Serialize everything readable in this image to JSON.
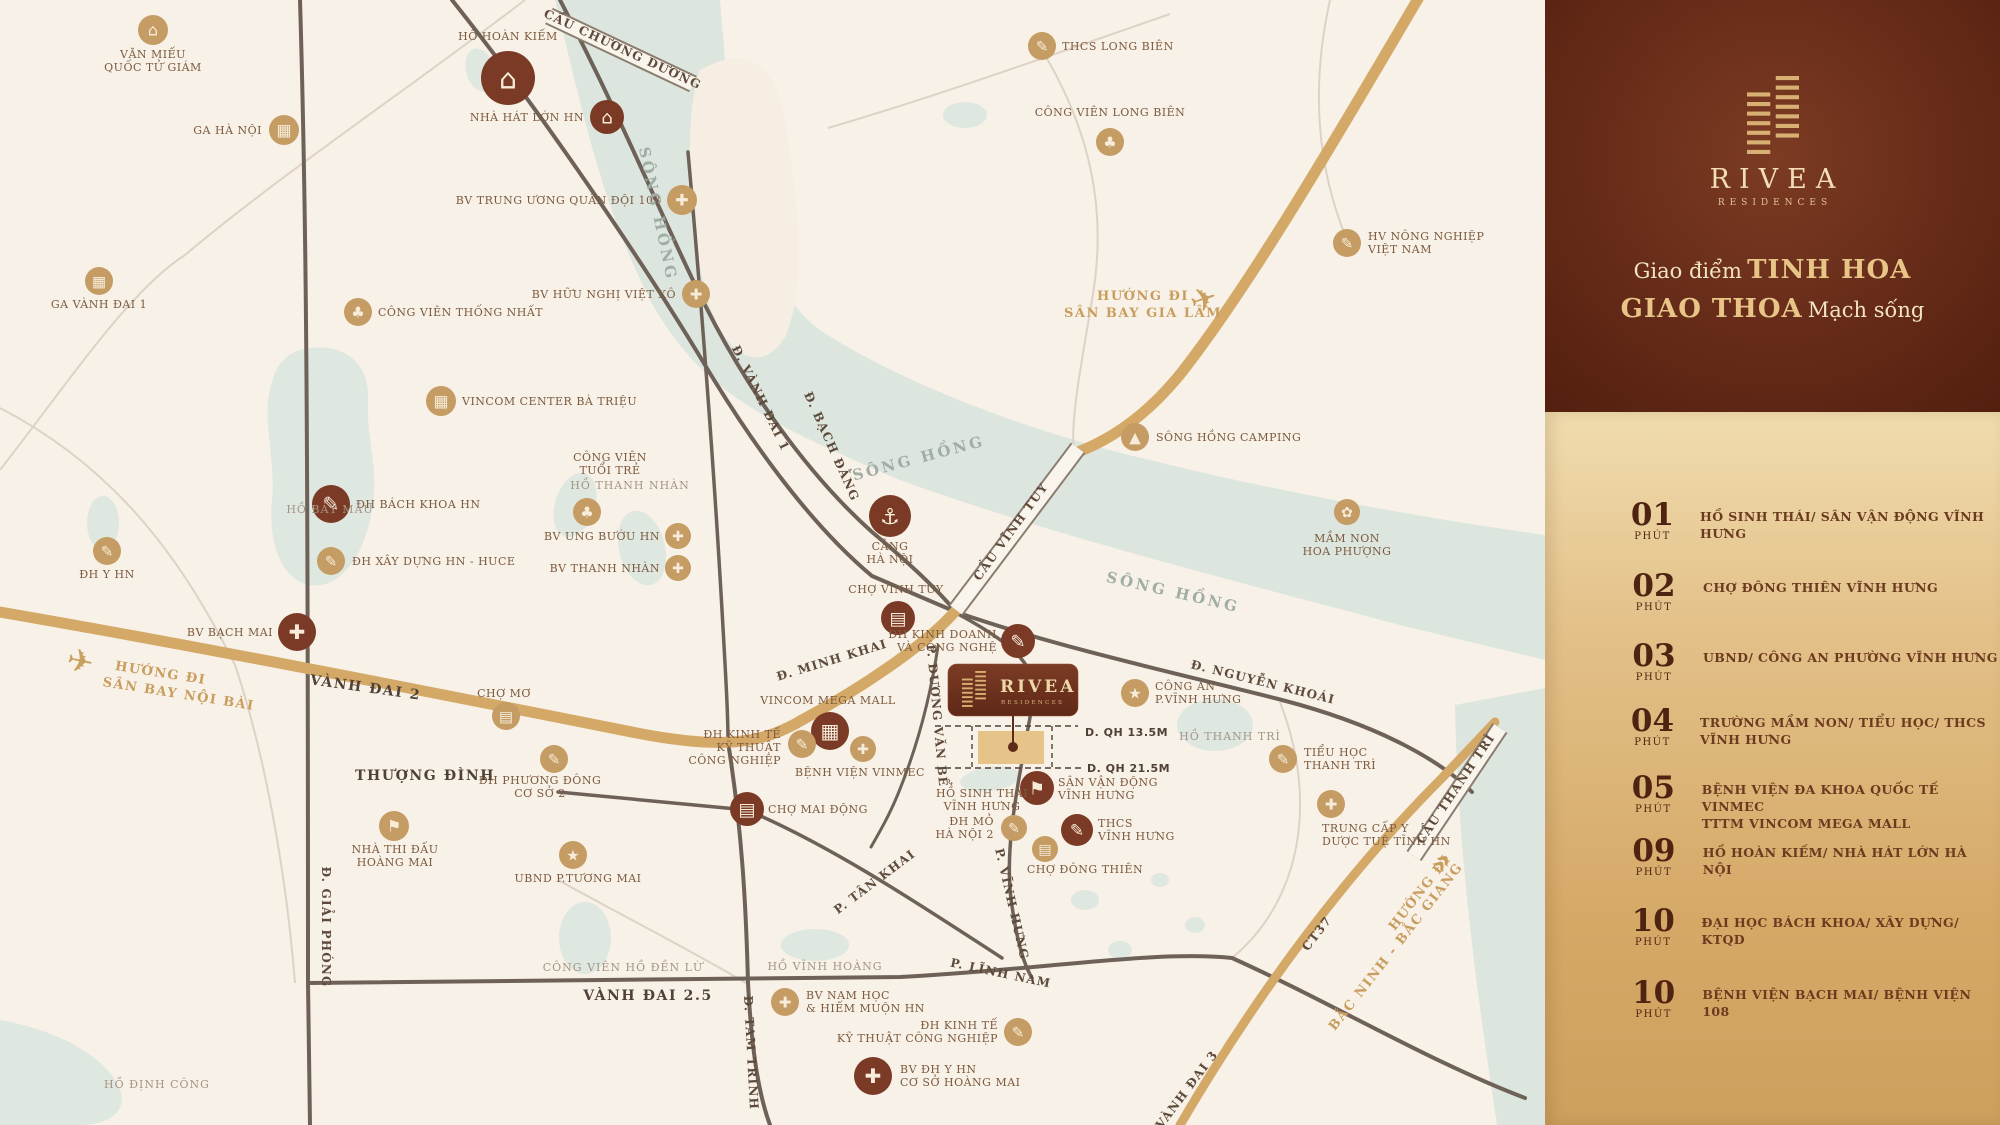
{
  "panel": {
    "brand": "RIVEA",
    "brand_sub": "RESIDENCES",
    "tagline": {
      "l1_regular": "Giao điểm",
      "l1_emphasis": "TINH HOA",
      "l2_emphasis": "GIAO THOA",
      "l2_regular": "Mạch sống"
    },
    "items": [
      {
        "minutes": "01",
        "unit": "PHÚT",
        "label": "HỒ SINH THÁI/ SÂN VẬN ĐỘNG VĨNH HƯNG"
      },
      {
        "minutes": "02",
        "unit": "PHÚT",
        "label": "CHỢ ĐÔNG THIÊN VĨNH HƯNG"
      },
      {
        "minutes": "03",
        "unit": "PHÚT",
        "label": "UBND/ CÔNG AN PHƯỜNG VĨNH HƯNG"
      },
      {
        "minutes": "04",
        "unit": "PHÚT",
        "label": "TRƯỜNG MẦM NON/ TIỂU HỌC/ THCS VĨNH HƯNG"
      },
      {
        "minutes": "05",
        "unit": "PHÚT",
        "label": "BỆNH VIỆN ĐA KHOA QUỐC TẾ VINMEC\nTTTM VINCOM MEGA MALL"
      },
      {
        "minutes": "09",
        "unit": "PHÚT",
        "label": "HỒ HOÀN KIẾM/ NHÀ HÁT LỚN HÀ NỘI"
      },
      {
        "minutes": "10",
        "unit": "PHÚT",
        "label": "ĐẠI HỌC BÁCH KHOA/ XÂY DỰNG/ KTQD"
      },
      {
        "minutes": "10",
        "unit": "PHÚT",
        "label": "BỆNH VIỆN BẠCH MAI/ BỆNH VIỆN 108"
      }
    ]
  },
  "map": {
    "project": {
      "name": "RIVEA",
      "subtitle": "RESIDENCES"
    },
    "colors": {
      "accent_dark": "#7b3a25",
      "accent_gold": "#c59c63",
      "road_gold": "#d4a967",
      "water": "#dce6df",
      "panel_brown": "#642a18"
    },
    "pois": [
      {
        "id": "van-mieu-quoc-tu-giam",
        "x": 153,
        "y": 30,
        "r": 15,
        "v": "gold",
        "i": "monument",
        "lines": [
          "VĂN MIẾU",
          "QUỐC TỬ GIÁM"
        ],
        "lx": 153,
        "ly": 58,
        "a": "middle"
      },
      {
        "id": "ga-ha-noi",
        "x": 284,
        "y": 130,
        "r": 15,
        "v": "gold",
        "i": "station",
        "lines": [
          "GA HÀ NỘI"
        ],
        "lx": 262,
        "ly": 134,
        "a": "end"
      },
      {
        "id": "ga-vanh-dai-1",
        "x": 99,
        "y": 281,
        "r": 14,
        "v": "gold",
        "i": "station",
        "lines": [
          "GA VÀNH ĐAI 1"
        ],
        "lx": 99,
        "ly": 308,
        "a": "middle"
      },
      {
        "id": "ho-hoan-kiem",
        "x": 508,
        "y": 78,
        "r": 27,
        "v": "dark",
        "i": "monument",
        "lines": [
          "HỒ HOÀN KIẾM"
        ],
        "lx": 508,
        "ly": 40,
        "a": "middle"
      },
      {
        "id": "nha-hat-lon-hn",
        "x": 607,
        "y": 117,
        "r": 17,
        "v": "dark",
        "i": "theatre",
        "lines": [
          "NHÀ HÁT LỚN HN"
        ],
        "lx": 584,
        "ly": 121,
        "a": "end"
      },
      {
        "id": "bv-trung-uong-quan-doi-108",
        "x": 682,
        "y": 200,
        "r": 15,
        "v": "gold",
        "i": "hospital",
        "lines": [
          "BV TRUNG ƯƠNG QUÂN ĐỘI 108"
        ],
        "lx": 661,
        "ly": 204,
        "a": "end"
      },
      {
        "id": "thcs-long-bien",
        "x": 1042,
        "y": 46,
        "r": 14,
        "v": "gold",
        "i": "school",
        "lines": [
          "THCS LONG BIÊN"
        ],
        "lx": 1062,
        "ly": 50,
        "a": "start"
      },
      {
        "id": "cong-vien-long-bien",
        "x": 1110,
        "y": 142,
        "r": 14,
        "v": "gold",
        "i": "park",
        "lines": [
          "CÔNG VIÊN LONG BIÊN"
        ],
        "lx": 1110,
        "ly": 116,
        "a": "middle"
      },
      {
        "id": "cong-vien-thong-nhat",
        "x": 358,
        "y": 312,
        "r": 14,
        "v": "gold",
        "i": "park",
        "lines": [
          "CÔNG VIÊN THỐNG NHẤT"
        ],
        "lx": 378,
        "ly": 316,
        "a": "start"
      },
      {
        "id": "bv-huu-nghi-viet-xo",
        "x": 696,
        "y": 294,
        "r": 14,
        "v": "gold",
        "i": "hospital",
        "lines": [
          "BV HỮU NGHỊ VIỆT XÔ"
        ],
        "lx": 676,
        "ly": 298,
        "a": "end"
      },
      {
        "id": "vincom-center-ba-trieu",
        "x": 441,
        "y": 401,
        "r": 15,
        "v": "gold",
        "i": "mall",
        "lines": [
          "VINCOM CENTER BÀ TRIỆU"
        ],
        "lx": 462,
        "ly": 405,
        "a": "start"
      },
      {
        "id": "hv-nong-nghiep-viet-nam",
        "x": 1347,
        "y": 243,
        "r": 14,
        "v": "gold",
        "i": "school",
        "lines": [
          "HV NÔNG NGHIỆP",
          "VIỆT NAM"
        ],
        "lx": 1368,
        "ly": 240,
        "a": "start"
      },
      {
        "id": "dh-bach-khoa-hn",
        "x": 331,
        "y": 504,
        "r": 19,
        "v": "dark",
        "i": "school",
        "lines": [
          "ĐH BÁCH KHOA HN"
        ],
        "lx": 356,
        "ly": 508,
        "a": "start"
      },
      {
        "id": "dh-xay-dung-hn-huce",
        "x": 331,
        "y": 561,
        "r": 14,
        "v": "gold",
        "i": "school",
        "lines": [
          "ĐH XÂY DỰNG HN - HUCE"
        ],
        "lx": 352,
        "ly": 565,
        "a": "start"
      },
      {
        "id": "dh-y-hn",
        "x": 107,
        "y": 551,
        "r": 14,
        "v": "gold",
        "i": "school",
        "lines": [
          "ĐH Y HN"
        ],
        "lx": 107,
        "ly": 578,
        "a": "middle"
      },
      {
        "id": "bv-bach-mai",
        "x": 297,
        "y": 632,
        "r": 19,
        "v": "dark",
        "i": "hospital",
        "lines": [
          "BV BẠCH MAI"
        ],
        "lx": 273,
        "ly": 636,
        "a": "end"
      },
      {
        "id": "cong-vien-tuoi-tre",
        "x": 587,
        "y": 512,
        "r": 14,
        "v": "gold",
        "i": "park",
        "lines": [
          "CÔNG VIÊN",
          "TUỔI TRẺ"
        ],
        "lx": 610,
        "ly": 461,
        "a": "middle"
      },
      {
        "id": "bv-ung-buou-hn",
        "x": 678,
        "y": 536,
        "r": 13,
        "v": "gold",
        "i": "hospital",
        "lines": [
          "BV UNG BƯỚU HN"
        ],
        "lx": 660,
        "ly": 540,
        "a": "end"
      },
      {
        "id": "bv-thanh-nhan",
        "x": 678,
        "y": 568,
        "r": 13,
        "v": "gold",
        "i": "hospital",
        "lines": [
          "BV THANH NHÀN"
        ],
        "lx": 660,
        "ly": 572,
        "a": "end"
      },
      {
        "id": "cang-ha-noi",
        "x": 890,
        "y": 516,
        "r": 21,
        "v": "dark",
        "i": "port",
        "lines": [
          "CẢNG",
          "HÀ NỘI"
        ],
        "lx": 890,
        "ly": 550,
        "a": "middle"
      },
      {
        "id": "cho-vinh-tuy",
        "x": 898,
        "y": 618,
        "r": 17,
        "v": "dark",
        "i": "market",
        "lines": [
          "CHỢ VĨNH TUY"
        ],
        "lx": 896,
        "ly": 593,
        "a": "middle"
      },
      {
        "id": "dh-kinh-doanh-va-cong-nghe",
        "x": 1018,
        "y": 641,
        "r": 17,
        "v": "dark",
        "i": "school",
        "lines": [
          "ĐH KINH DOANH",
          "VÀ CÔNG NGHỆ"
        ],
        "lx": 997,
        "ly": 638,
        "a": "end"
      },
      {
        "id": "cong-an-p-vinh-hung",
        "x": 1135,
        "y": 693,
        "r": 14,
        "v": "gold",
        "i": "gov",
        "lines": [
          "CÔNG AN",
          "P.VĨNH HƯNG"
        ],
        "lx": 1155,
        "ly": 690,
        "a": "start"
      },
      {
        "id": "vincom-mega-mall",
        "x": 830,
        "y": 731,
        "r": 19,
        "v": "dark",
        "i": "mall",
        "lines": [
          "VINCOM MEGA MALL"
        ],
        "lx": 828,
        "ly": 704,
        "a": "middle"
      },
      {
        "id": "dh-kinh-te-ky-thuat-cong-nghiep",
        "x": 802,
        "y": 744,
        "r": 14,
        "v": "gold",
        "i": "school",
        "lines": [
          "ĐH KINH TẾ",
          "KỸ THUẬT",
          "CÔNG NGHIỆP"
        ],
        "lx": 781,
        "ly": 738,
        "a": "end"
      },
      {
        "id": "benh-vien-vinmec",
        "x": 863,
        "y": 749,
        "r": 13,
        "v": "gold",
        "i": "hospital",
        "lines": [
          "BỆNH VIỆN VINMEC"
        ],
        "lx": 860,
        "ly": 776,
        "a": "middle"
      },
      {
        "id": "cho-mai-dong",
        "x": 747,
        "y": 809,
        "r": 17,
        "v": "dark",
        "i": "market",
        "lines": [
          "CHỢ MAI ĐỘNG"
        ],
        "lx": 768,
        "ly": 813,
        "a": "start"
      },
      {
        "id": "mam-non-hoa-phuong",
        "x": 1347,
        "y": 512,
        "r": 13,
        "v": "gold",
        "i": "flower",
        "lines": [
          "MẦM NON",
          "HOA PHƯỢNG"
        ],
        "lx": 1347,
        "ly": 542,
        "a": "middle"
      },
      {
        "id": "tieu-hoc-thanh-tri",
        "x": 1283,
        "y": 759,
        "r": 14,
        "v": "gold",
        "i": "school",
        "lines": [
          "TIỂU HỌC",
          "THANH TRÌ"
        ],
        "lx": 1304,
        "ly": 756,
        "a": "start"
      },
      {
        "id": "san-van-dong-vinh-hung",
        "x": 1037,
        "y": 788,
        "r": 17,
        "v": "dark",
        "i": "stadium",
        "lines": [
          "SÂN VẬN ĐỘNG",
          "VĨNH HƯNG"
        ],
        "lx": 1058,
        "ly": 786,
        "a": "start"
      },
      {
        "id": "thcs-vinh-hung",
        "x": 1077,
        "y": 830,
        "r": 16,
        "v": "dark",
        "i": "school",
        "lines": [
          "THCS",
          "VĨNH HƯNG"
        ],
        "lx": 1098,
        "ly": 827,
        "a": "start"
      },
      {
        "id": "cho-dong-thien",
        "x": 1045,
        "y": 849,
        "r": 13,
        "v": "gold",
        "i": "market",
        "lines": [
          "CHỢ ĐÔNG THIÊN"
        ],
        "lx": 1085,
        "ly": 873,
        "a": "middle"
      },
      {
        "id": "trung-cap-y-duoc-tue-tinh-hn",
        "x": 1331,
        "y": 804,
        "r": 14,
        "v": "gold",
        "i": "hospital",
        "lines": [
          "TRUNG CẤP Y",
          "DƯỢC TUỆ TĨNH HN"
        ],
        "lx": 1322,
        "ly": 832,
        "a": "start"
      },
      {
        "id": "dh-mo-ha-noi-2",
        "x": 1014,
        "y": 828,
        "r": 13,
        "v": "gold",
        "i": "school",
        "lines": [
          "ĐH MỎ",
          "HÀ NỘI 2"
        ],
        "lx": 994,
        "ly": 825,
        "a": "end"
      },
      {
        "id": "ubnd-p-tuong-mai",
        "x": 573,
        "y": 855,
        "r": 14,
        "v": "gold",
        "i": "gov",
        "lines": [
          "UBND P.TƯƠNG MAI"
        ],
        "lx": 578,
        "ly": 882,
        "a": "middle"
      },
      {
        "id": "nha-thi-dau-hoang-mai",
        "x": 394,
        "y": 826,
        "r": 15,
        "v": "gold",
        "i": "stadium",
        "lines": [
          "NHÀ THI ĐẤU",
          "HOÀNG MAI"
        ],
        "lx": 395,
        "ly": 853,
        "a": "middle"
      },
      {
        "id": "dh-phuong-dong-co-so-2",
        "x": 554,
        "y": 759,
        "r": 14,
        "v": "gold",
        "i": "school",
        "lines": [
          "ĐH PHƯƠNG ĐÔNG",
          "CƠ SỞ 2"
        ],
        "lx": 540,
        "ly": 784,
        "a": "middle"
      },
      {
        "id": "cho-mo",
        "x": 506,
        "y": 716,
        "r": 14,
        "v": "gold",
        "i": "market",
        "lines": [
          "CHỢ MƠ"
        ],
        "lx": 504,
        "ly": 697,
        "a": "middle"
      },
      {
        "id": "bv-nam-hoc-hiem-muon-hn",
        "x": 785,
        "y": 1002,
        "r": 14,
        "v": "gold",
        "i": "hospital",
        "lines": [
          "BV NAM HỌC",
          "& HIẾM MUỘN HN"
        ],
        "lx": 806,
        "ly": 999,
        "a": "start"
      },
      {
        "id": "dh-kinh-te-ky-thuat-cong-nghiep-2",
        "x": 1018,
        "y": 1032,
        "r": 14,
        "v": "gold",
        "i": "school",
        "lines": [
          "ĐH KINH TẾ",
          "KỸ THUẬT CÔNG NGHIỆP"
        ],
        "lx": 998,
        "ly": 1029,
        "a": "end"
      },
      {
        "id": "bv-dh-y-hn-co-so-hoang-mai",
        "x": 873,
        "y": 1076,
        "r": 19,
        "v": "dark",
        "i": "hospital",
        "lines": [
          "BV ĐH Y HN",
          "CƠ SỞ HOÀNG MAI"
        ],
        "lx": 900,
        "ly": 1073,
        "a": "start"
      },
      {
        "id": "song-hong-camping",
        "x": 1135,
        "y": 437,
        "r": 14,
        "v": "gold",
        "i": "camp",
        "lines": [
          "SÔNG HỒNG CAMPING"
        ],
        "lx": 1156,
        "ly": 441,
        "a": "start"
      }
    ],
    "labels": [
      {
        "t": "Đ. VÀNH ĐAI 1",
        "x": 757,
        "y": 400,
        "r": 64,
        "c": "rl"
      },
      {
        "t": "Đ. BẠCH ĐẰNG",
        "x": 828,
        "y": 448,
        "r": 66,
        "c": "rl"
      },
      {
        "t": "Đ. MINH KHAI",
        "x": 833,
        "y": 664,
        "r": -17,
        "c": "rl"
      },
      {
        "t": "VÀNH ĐAI 2",
        "x": 365,
        "y": 692,
        "r": 8,
        "c": "rlb"
      },
      {
        "t": "VÀNH ĐAI 2.5",
        "x": 648,
        "y": 1000,
        "r": 0,
        "c": "rlb"
      },
      {
        "t": "THƯỢNG ĐÌNH",
        "x": 425,
        "y": 780,
        "r": 0,
        "c": "rlb"
      },
      {
        "t": "Đ. GIẢI PHÓNG",
        "x": 322,
        "y": 927,
        "r": 90,
        "c": "rl"
      },
      {
        "t": "Đ. TAM TRINH",
        "x": 747,
        "y": 1053,
        "r": 87,
        "c": "rl"
      },
      {
        "t": "P. TÂN KHAI",
        "x": 877,
        "y": 885,
        "r": -37,
        "c": "rl"
      },
      {
        "t": "P. VĨNH HƯNG",
        "x": 1008,
        "y": 905,
        "r": 77,
        "c": "rl"
      },
      {
        "t": "P. LĨNH NAM",
        "x": 1000,
        "y": 977,
        "r": 12,
        "c": "rl"
      },
      {
        "t": "P. DƯƠNG VĂN BỂ",
        "x": 933,
        "y": 716,
        "r": 85,
        "c": "rl"
      },
      {
        "t": "Đ. NGUYỄN KHOÁI",
        "x": 1262,
        "y": 686,
        "r": 14,
        "c": "rl"
      },
      {
        "t": "VÀNH ĐAI 3",
        "x": 1190,
        "y": 1092,
        "r": -53,
        "c": "rl"
      },
      {
        "t": "CT37",
        "x": 1320,
        "y": 936,
        "r": -52,
        "c": "rl"
      },
      {
        "t": "CẦU CHƯƠNG DƯƠNG",
        "x": 621,
        "y": 53,
        "r": 25,
        "c": "rl"
      },
      {
        "t": "CẦU VĨNH TUY",
        "x": 1014,
        "y": 534,
        "r": -54,
        "c": "rl"
      },
      {
        "t": "CẦU THANH TRÌ",
        "x": 1459,
        "y": 791,
        "r": -56,
        "c": "rl"
      },
      {
        "t": "HƯỚNG ĐI",
        "x": 160,
        "y": 677,
        "r": 9,
        "c": "gld"
      },
      {
        "t": "SÂN BAY NỘI BÀI",
        "x": 178,
        "y": 698,
        "r": 9,
        "c": "gld"
      },
      {
        "t": "HƯỚNG ĐI",
        "x": 1143,
        "y": 300,
        "r": 0,
        "c": "gld"
      },
      {
        "t": "SÂN BAY GIA LÂM",
        "x": 1143,
        "y": 317,
        "r": 0,
        "c": "gld"
      },
      {
        "t": "HƯỚNG ĐI",
        "x": 1423,
        "y": 895,
        "r": -52,
        "c": "gld"
      },
      {
        "t": "BẮC NINH - BẮC GIANG",
        "x": 1399,
        "y": 949,
        "r": -52,
        "c": "gld"
      },
      {
        "t": "»",
        "x": 1449,
        "y": 868,
        "r": -52,
        "c": "garr"
      },
      {
        "t": "✈",
        "x": 78,
        "y": 672,
        "r": 12,
        "c": "plane"
      },
      {
        "t": "✈",
        "x": 1207,
        "y": 310,
        "r": -18,
        "c": "plane"
      },
      {
        "t": "SÔNG HỒNG",
        "x": 653,
        "y": 215,
        "r": 78,
        "c": "wl"
      },
      {
        "t": "SÔNG HỒNG",
        "x": 920,
        "y": 463,
        "r": -15,
        "c": "wl"
      },
      {
        "t": "SÔNG HỒNG",
        "x": 1172,
        "y": 597,
        "r": 13,
        "c": "wl"
      },
      {
        "t": "HỒ BẢY MẪU",
        "x": 330,
        "y": 513,
        "r": 0,
        "c": "ll"
      },
      {
        "t": "HỒ THANH NHÀN",
        "x": 630,
        "y": 489,
        "r": 0,
        "c": "ll"
      },
      {
        "t": "HỒ THANH TRÌ",
        "x": 1230,
        "y": 740,
        "r": 0,
        "c": "ll"
      },
      {
        "t": "HỒ VĨNH HOÀNG",
        "x": 825,
        "y": 970,
        "r": 0,
        "c": "ll"
      },
      {
        "t": "HỒ ĐỊNH CÔNG",
        "x": 157,
        "y": 1088,
        "r": 0,
        "c": "ll"
      },
      {
        "t": "CÔNG VIÊN HỒ ĐỀN LỪ",
        "x": 623,
        "y": 971,
        "r": 0,
        "c": "ll"
      },
      {
        "t": "HỒ SINH THÁI",
        "x": 982,
        "y": 797,
        "r": 0,
        "c": "al"
      },
      {
        "t": "VĨNH HƯNG",
        "x": 982,
        "y": 810,
        "r": 0,
        "c": "al"
      },
      {
        "t": "D. QH 13.5M",
        "x": 1085,
        "y": 736,
        "r": 0,
        "c": "qh",
        "a": "start"
      },
      {
        "t": "D. QH 21.5M",
        "x": 1087,
        "y": 772,
        "r": 0,
        "c": "qh",
        "a": "start"
      }
    ]
  }
}
